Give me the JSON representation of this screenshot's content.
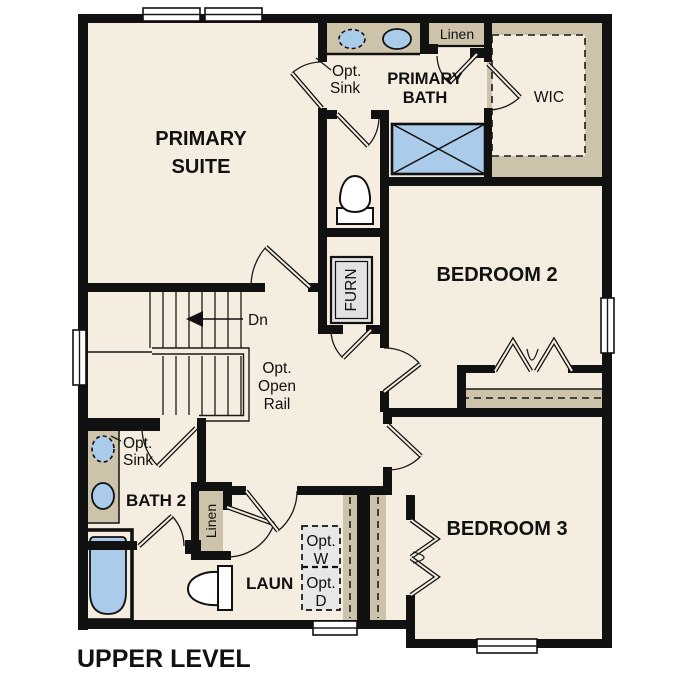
{
  "title": "UPPER LEVEL",
  "rooms": {
    "primary_suite": {
      "line1": "PRIMARY",
      "line2": "SUITE"
    },
    "primary_bath": {
      "line1": "PRIMARY",
      "line2": "BATH"
    },
    "wic": "WIC",
    "bedroom_2": "BEDROOM 2",
    "bedroom_3": "BEDROOM 3",
    "bath_2": "BATH 2",
    "laundry": "LAUN"
  },
  "labels": {
    "opt": "Opt.",
    "sink": "Sink",
    "linen": "Linen",
    "open": "Open",
    "rail": "Rail",
    "down": "Dn",
    "furnace": "FURN",
    "washer": "W",
    "dryer": "D"
  },
  "colors": {
    "floor": "#f5eee0",
    "casework": "#cdc3aa",
    "fixture_blue": "#abcbea",
    "appliance_gray": "#e7e7e7",
    "wall_black": "#111111"
  }
}
